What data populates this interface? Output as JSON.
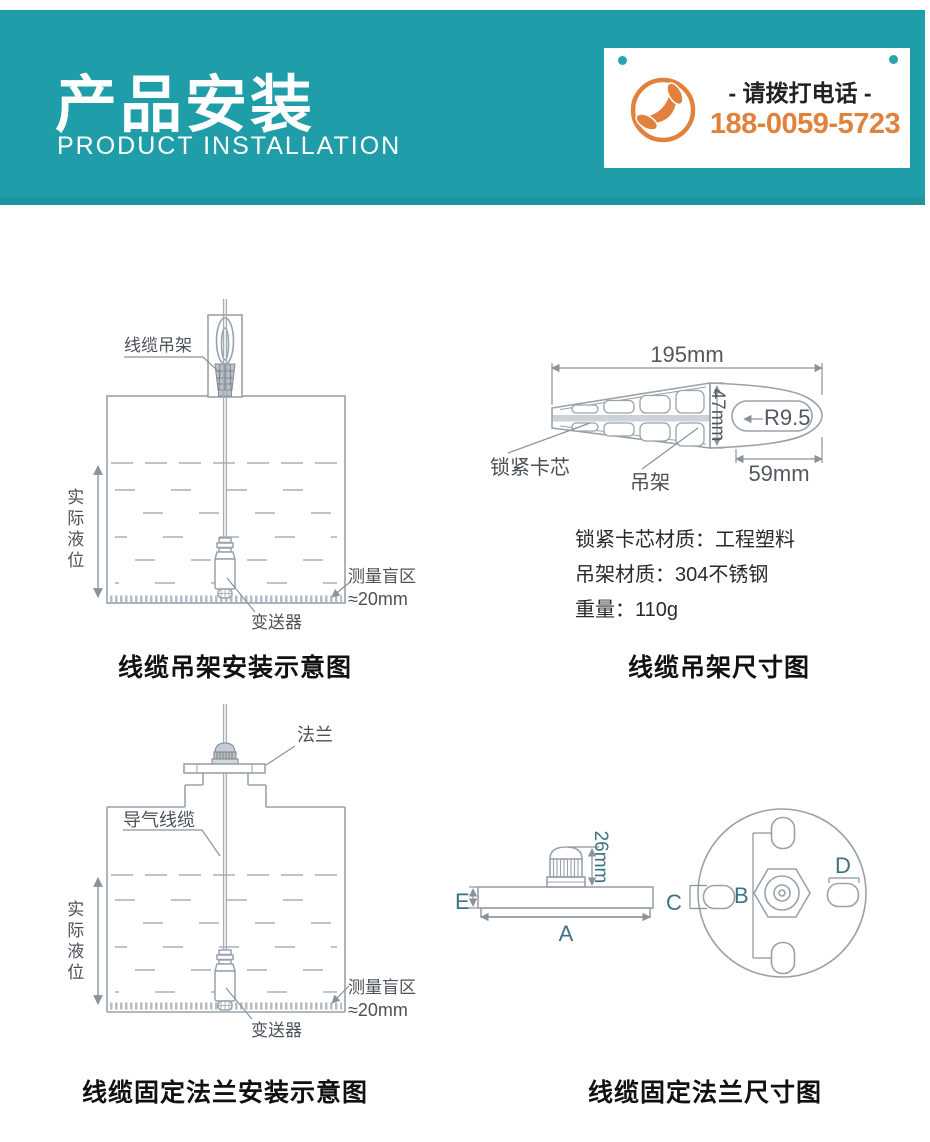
{
  "banner": {
    "title": "产品安装",
    "subtitle": "PRODUCT INSTALLATION",
    "colors": {
      "teal": "#1f9da8",
      "orange": "#e0813c"
    },
    "phone": {
      "label": "- 请拨打电话 -",
      "number": "188-0059-5723"
    }
  },
  "hanger_install": {
    "cable_hanger_label": "线缆吊架",
    "actual_level_label": "实际液位",
    "blind_zone_label": "测量盲区",
    "blind_zone_value": "≈20mm",
    "transmitter_label": "变送器",
    "caption": "线缆吊架安装示意图"
  },
  "hanger_dims": {
    "length": "195mm",
    "height": "47mm",
    "hole_radius": "R9.5",
    "tail_width": "59mm",
    "lock_core_label": "锁紧卡芯",
    "hanger_label": "吊架",
    "specs": [
      "锁紧卡芯材质：工程塑料",
      "吊架材质：304不锈钢",
      "重量：110g"
    ],
    "caption": "线缆吊架尺寸图"
  },
  "flange_install": {
    "flange_label": "法兰",
    "air_cable_label": "导气线缆",
    "actual_level_label": "实际液位",
    "blind_zone_label": "测量盲区",
    "blind_zone_value": "≈20mm",
    "transmitter_label": "变送器",
    "caption": "线缆固定法兰安装示意图"
  },
  "flange_dims": {
    "gland_height": "26mm",
    "dim_a": "A",
    "dim_b": "B",
    "dim_c": "C",
    "dim_d": "D",
    "dim_e": "E",
    "caption": "线缆固定法兰尺寸图"
  }
}
